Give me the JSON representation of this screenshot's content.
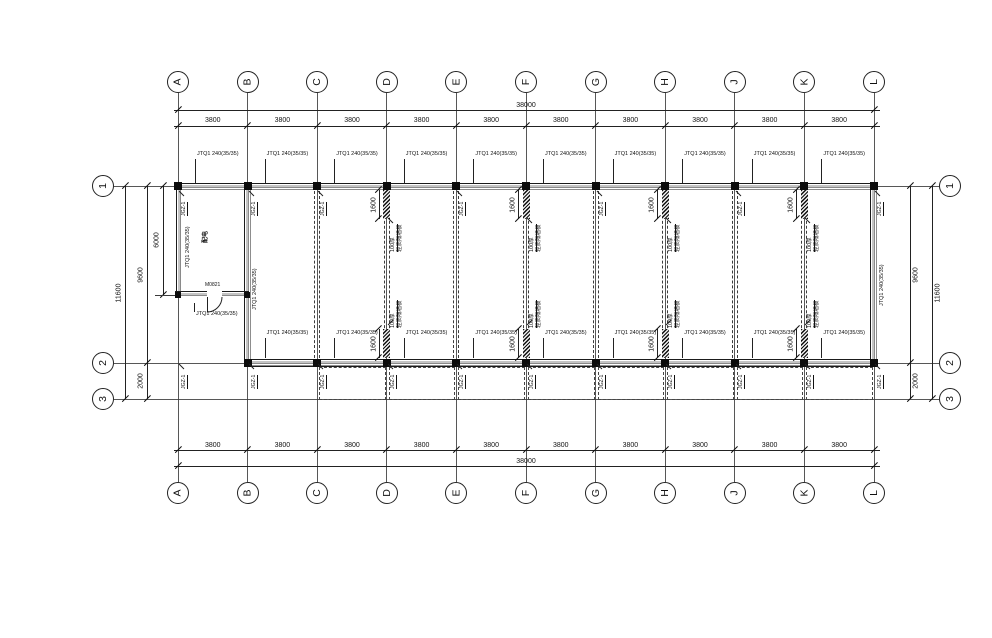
{
  "meta": {
    "background": "#ffffff",
    "ink_color": "#1c1c1c",
    "wall_inner_line_color": "#8a8a8a",
    "drawing_type": "structural floor plan"
  },
  "grid": {
    "columns": [
      "A",
      "B",
      "C",
      "D",
      "E",
      "F",
      "G",
      "H",
      "J",
      "K",
      "L"
    ],
    "rows": [
      "1",
      "2",
      "3"
    ]
  },
  "dims": {
    "total_width": "38000",
    "bay": "3800",
    "depth_main": "9600",
    "depth_canopy": "2000",
    "depth_total": "11600",
    "room_depth": "6000",
    "strip": "1600"
  },
  "labels": {
    "wall_tag": "JTQ1 240(35/35)",
    "column_tag": "JGZ-1",
    "door_tag": "M0821",
    "room_name": "配电",
    "partition_note_l1": "100厚",
    "partition_note_l2": "轻质隔墙板"
  }
}
